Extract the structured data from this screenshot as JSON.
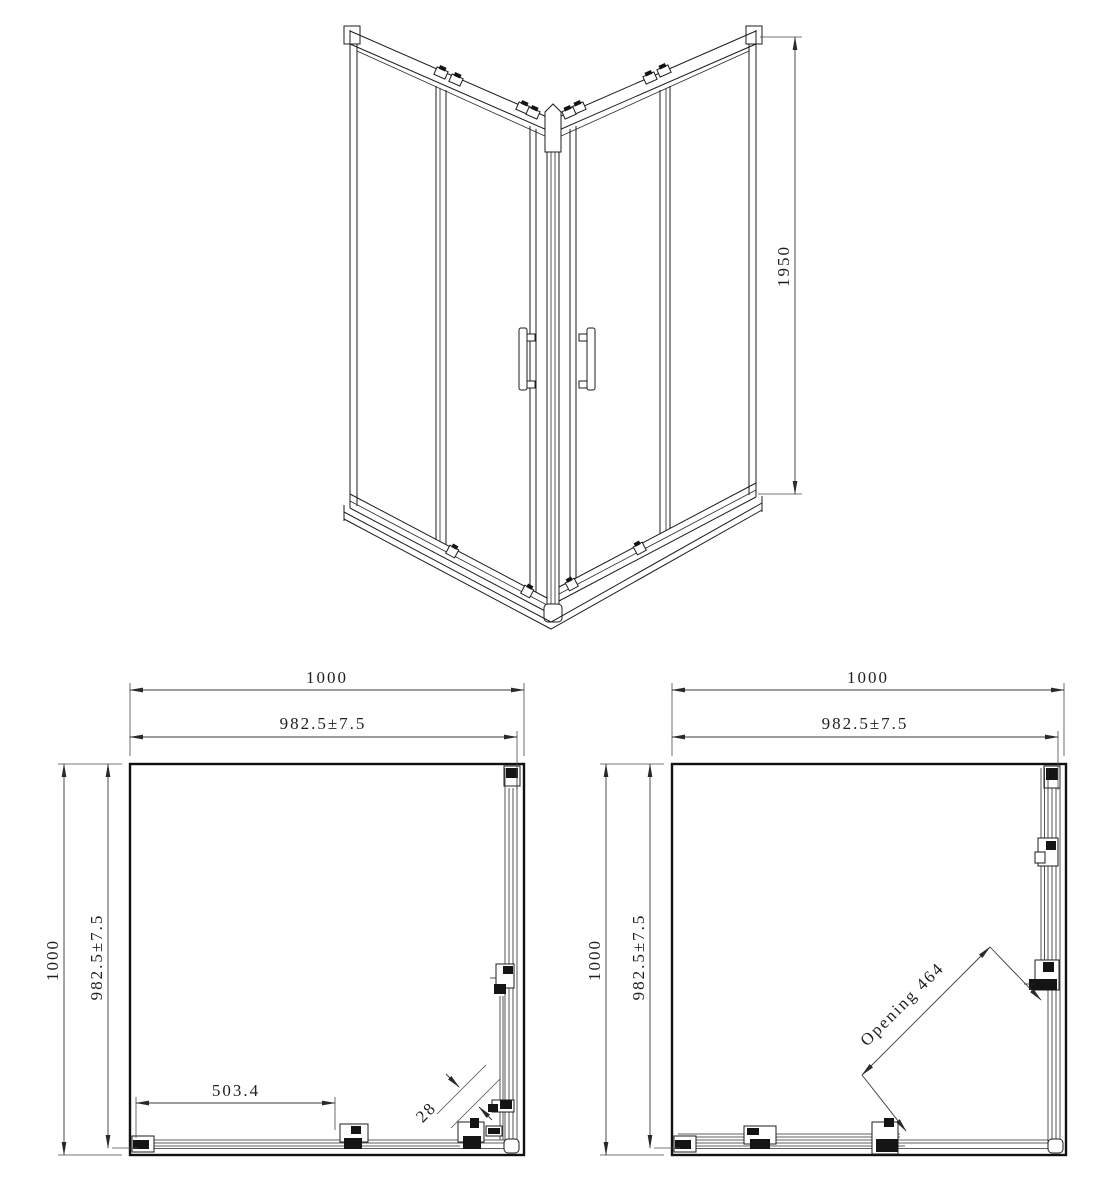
{
  "drawing": {
    "background": "#ffffff",
    "line_color": "#1c1c1c",
    "views": {
      "perspective": {
        "label": "corner-entry shower enclosure perspective",
        "dims": {
          "height": "1950"
        }
      },
      "plan_closed": {
        "label": "plan view doors closed",
        "dims": {
          "width_outer": "1000",
          "width_inner": "982.5±7.5",
          "depth_outer": "1000",
          "depth_inner": "982.5±7.5",
          "door_panel": "503.4",
          "corner_gap": "28"
        }
      },
      "plan_open": {
        "label": "plan view doors open",
        "dims": {
          "width_outer": "1000",
          "width_inner": "982.5±7.5",
          "depth_outer": "1000",
          "depth_inner": "982.5±7.5",
          "opening": "Opening 464"
        }
      }
    }
  }
}
